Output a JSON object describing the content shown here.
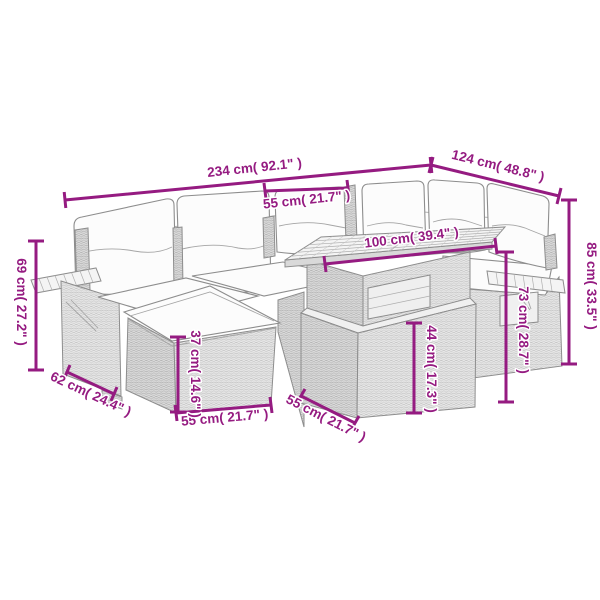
{
  "diagram": {
    "type": "product-dimension-diagram",
    "subject": "poly rattan corner sofa set with cushions, footstool and table",
    "background_color": "#ffffff",
    "accent_color": "#951b81",
    "line_color": "#8d8d8d",
    "dimensions": [
      {
        "id": "sofa-total-width",
        "cm": 234,
        "inch": 92.1,
        "orientation": "horizontal",
        "label": "234 cm( 92.1\" )"
      },
      {
        "id": "sofa-right-length",
        "cm": 124,
        "inch": 48.8,
        "orientation": "diagonal",
        "label": "124 cm( 48.8\" )"
      },
      {
        "id": "backrest-width",
        "cm": 55,
        "inch": 21.7,
        "orientation": "horizontal",
        "label": "55 cm( 21.7\" )"
      },
      {
        "id": "table-top-width",
        "cm": 100,
        "inch": 39.4,
        "orientation": "diagonal",
        "label": "100 cm( 39.4\" )"
      },
      {
        "id": "total-height",
        "cm": 85,
        "inch": 33.5,
        "orientation": "vertical",
        "label": "85 cm( 33.5\" )"
      },
      {
        "id": "armrest-height",
        "cm": 73,
        "inch": 28.7,
        "orientation": "vertical",
        "label": "73 cm( 28.7\" )"
      },
      {
        "id": "arm-shelf-height",
        "cm": 69,
        "inch": 27.2,
        "orientation": "vertical",
        "label": "69 cm( 27.2\" )"
      },
      {
        "id": "armrest-depth",
        "cm": 62,
        "inch": 24.4,
        "orientation": "diagonal",
        "label": "62 cm( 24.4\" )"
      },
      {
        "id": "footstool-width",
        "cm": 55,
        "inch": 21.7,
        "orientation": "horizontal",
        "label": "55 cm( 21.7\" )"
      },
      {
        "id": "footstool-height",
        "cm": 37,
        "inch": 14.6,
        "orientation": "vertical",
        "label": "37 cm( 14.6\" )"
      },
      {
        "id": "table-height",
        "cm": 44,
        "inch": 17.3,
        "orientation": "vertical",
        "label": "44 cm( 17.3\" )"
      },
      {
        "id": "table-depth",
        "cm": 55,
        "inch": 21.7,
        "orientation": "diagonal",
        "label": "55 cm( 21.7\" )"
      }
    ]
  }
}
